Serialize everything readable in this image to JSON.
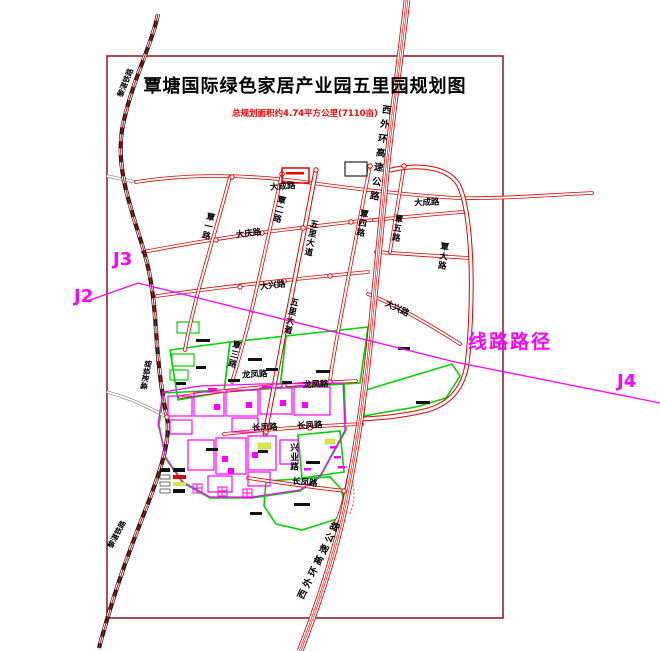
{
  "title": "覃塘国际绿色家居产业园五里园规划图",
  "subtitle": "总规划面积约4.74平方公里(7110亩)",
  "route_line": {
    "label": "线路路径",
    "markers": {
      "j2": "J2",
      "j3": "J3",
      "j4": "J4"
    }
  },
  "roads": {
    "dacheng": "大成路",
    "daqing": "大庆路",
    "daxing": "大兴路",
    "longfeng": "龙凤路",
    "changfeng": "长凤路",
    "xingye": "兴业路",
    "qinyi": "覃一路",
    "qiner": "覃二路",
    "qinsan": "覃三路",
    "wuli_avenue": "五里大道",
    "qinsi": "覃四路",
    "qinwu": "覃五路",
    "qinda": "覃大路"
  },
  "expressway": "西外环高速公路",
  "railway": "黎湛铁路",
  "colors": {
    "frame": "#8a1420",
    "road_red": "#e60000",
    "subtitle_red": "#ff0000",
    "route_magenta": "#ff00ff",
    "parcel_green": "#00d400",
    "parcel_magenta": "#ff00ff",
    "railway_black": "#1a1a1a",
    "legend_yellow": "#d8e84a"
  }
}
